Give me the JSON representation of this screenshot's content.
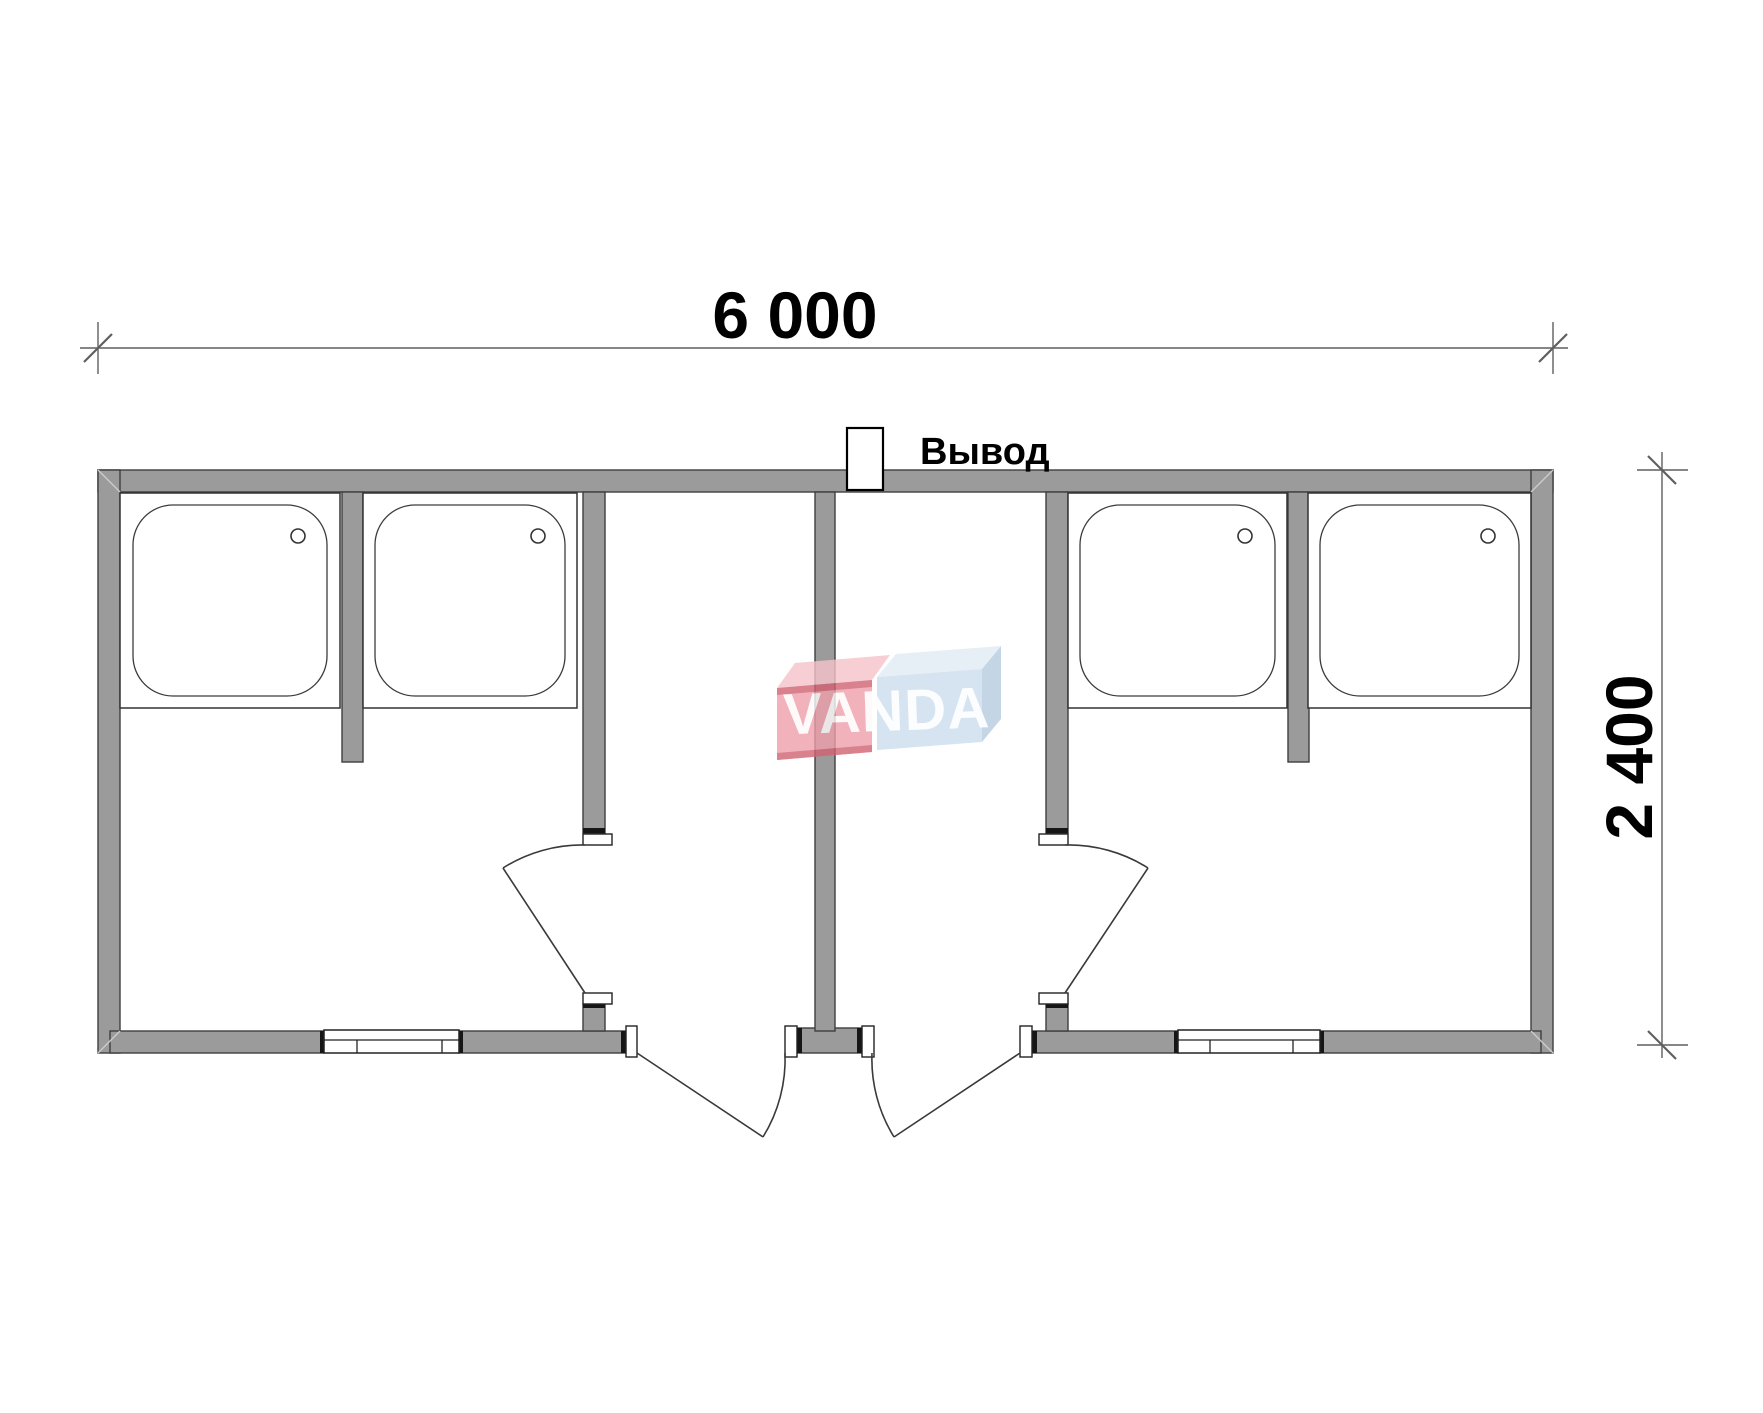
{
  "page": {
    "background": "#ffffff"
  },
  "dimensions": {
    "width_label": "6 000",
    "height_label": "2 400"
  },
  "labels": {
    "outlet": "Вывод"
  },
  "watermark": {
    "text": "VANDA",
    "text_color": "#ffffff",
    "red_front": "#ef9fab",
    "red_top": "#f6c3ca",
    "red_edge": "#d26273",
    "blue_front": "#ccdded",
    "blue_top": "#e0ebf4",
    "blue_side": "#b6cde1"
  },
  "colors": {
    "wall_fill": "#9b9b9b",
    "wall_outline": "#3f3f3f",
    "end_cap": "#161616",
    "fixture_line": "#333333",
    "door_line": "#3a3a3a",
    "dim_line": "#5f5f5f",
    "text": "#000000"
  },
  "counts": {
    "shower_trays": 4,
    "doors": 4,
    "windows": 2,
    "rooms": 2
  }
}
